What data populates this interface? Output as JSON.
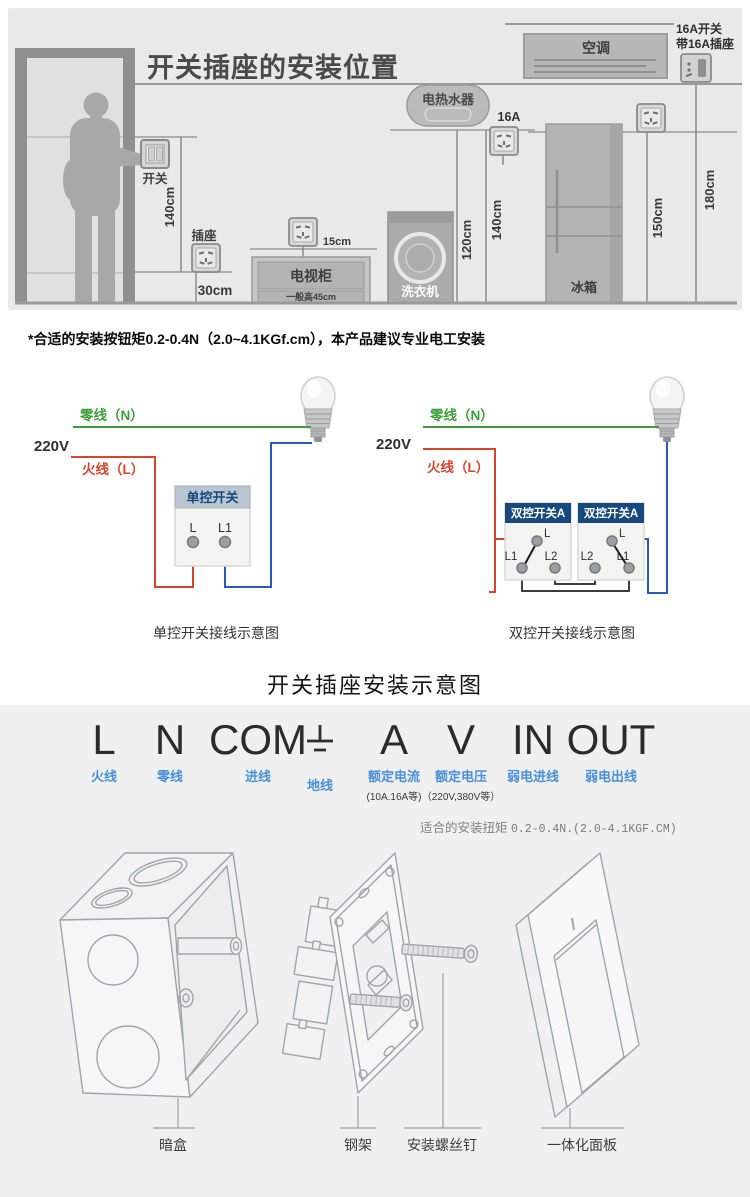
{
  "top": {
    "title": "开关插座的安装位置",
    "switch_label": "开关",
    "socket_label": "插座",
    "tv_label": "电视柜",
    "tv_note": "一般高45cm",
    "washer_label": "洗衣机",
    "heater_label": "电热水器",
    "heater_socket_amp": "16A",
    "fridge_label": "冰箱",
    "ac_label": "空调",
    "ac_socket_line1": "16A开关",
    "ac_socket_line2": "带16A插座",
    "dim_switch": "140cm",
    "dim_socket": "30cm",
    "dim_tv": "15cm",
    "dim_washer": "120cm",
    "dim_heater": "140cm",
    "dim_fridge": "150cm",
    "dim_ac": "180cm"
  },
  "note": "*合适的安装按钮矩0.2-0.4N（2.0~4.1KGf.cm），本产品建议专业电工安装",
  "wiring": {
    "left": {
      "neutral": "零线（N）",
      "voltage": "220V",
      "live": "火线（L）",
      "switch_title": "单控开关",
      "terminal_l": "L",
      "terminal_l1": "L1",
      "caption": "单控开关接线示意图"
    },
    "right": {
      "neutral": "零线（N）",
      "voltage": "220V",
      "live": "火线（L）",
      "box_a": "双控开关A",
      "box_b": "双控开关A",
      "a_l": "L",
      "a_l1": "L1",
      "a_l2": "L2",
      "b_l": "L",
      "b_l1": "L1",
      "b_l2": "L2",
      "caption": "双控开关接线示意图"
    }
  },
  "section_title": "开关插座安装示意图",
  "legend": {
    "items": [
      {
        "symbol": "L",
        "label": "火线",
        "note": ""
      },
      {
        "symbol": "N",
        "label": "零线",
        "note": ""
      },
      {
        "symbol": "COM",
        "label": "进线",
        "note": ""
      },
      {
        "symbol": "⏚",
        "label": "地线",
        "note": ""
      },
      {
        "symbol": "A",
        "label": "额定电流",
        "note": "(10A.16A等)"
      },
      {
        "symbol": "V",
        "label": "额定电压",
        "note": "（220V,380V等）"
      },
      {
        "symbol": "IN",
        "label": "弱电进线",
        "note": ""
      },
      {
        "symbol": "OUT",
        "label": "弱电出线",
        "note": ""
      }
    ],
    "torque_label": "适合的安装扭矩",
    "torque_value": "0.2-0.4N.(2.0-4.1KGF.CM)"
  },
  "parts": {
    "captions": [
      "暗盒",
      "钢架",
      "安装螺丝钉",
      "一体化面板"
    ]
  },
  "colors": {
    "neutral_green": "#3f9c3a",
    "live_red": "#d6442c",
    "load_blue": "#2b59c3",
    "legend_blue": "#4a90d8",
    "header_navy": "#17497e"
  }
}
